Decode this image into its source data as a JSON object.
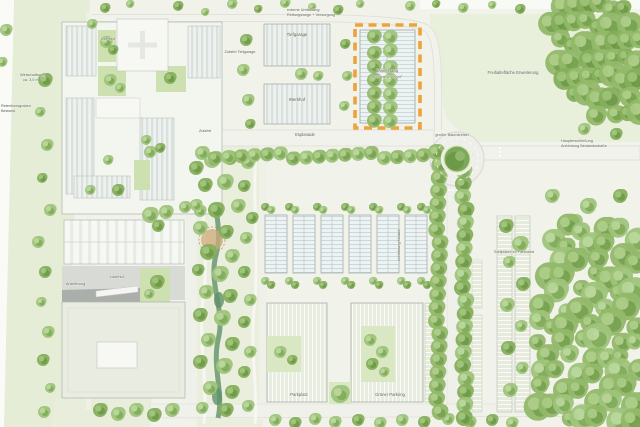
{
  "plan": {
    "labels": {
      "ring1": "externe Umfahrung",
      "ring2": "Rettungswege + Versorgung",
      "wirtschaftsweg1": "Wirtschaftsweg",
      "wirtschaftsweg2": "ca. 3,0 m",
      "retention1": "Retentionsgraben",
      "retention2": "Bestand",
      "innenhof": "Innenhof",
      "zufahrt_tiefgarage": "Zufahrt Tiefgarage",
      "tiefgarage": "Tiefgarage",
      "werkhof": "Werkhof",
      "erweiterung1": "Erweiterung",
      "erweiterung2": "BGF ca. 5.000 m²",
      "freihalteflaeche": "Freihaltefläche Erweiterung",
      "zufahrt": "Zufahrt",
      "esplanade": "Esplanade",
      "kreisel": "großer Baumkreisel",
      "anbindung1": "Haupterschließung",
      "anbindung2": "Anbindung Bestandsstraße",
      "parkband": "Stellplätze im Parkband",
      "module": "Umfahrung Module",
      "anlieferung": "Anlieferung",
      "ladehof": "Ladehof",
      "parkplatz": "Parkplatz",
      "parkring": "Grüner Parkring"
    },
    "highlight": {
      "name": "Erweiterungsfläche (orange markiert)",
      "color": "#EDA33B"
    }
  },
  "colors": {
    "accent_orange": "#EDA33B",
    "campus_ground": "#F1F3EA",
    "field_green": "#E5EDD7",
    "meadow_green": "#E8EFDB",
    "park_green": "#E9EFDC",
    "courtyard_green": "#CDE0B0",
    "hedge_green": "#D3E2BA",
    "road_gray": "#F2F2ED",
    "road_edge": "#DBDBD4",
    "building_white": "#F3F5EF",
    "roof_stripe": "#D9E1DE",
    "glass_roof": "#EDF2F2",
    "glass_line": "#CBD9DD",
    "gray_roof": "#ABAFAB",
    "apron_gray": "#D8DAD5",
    "water_green": "#5F9168",
    "sand_brown": "#CFA97A",
    "tree_base": "#9FC47C",
    "tree_dark": "#7FAB57",
    "tree_light": "#B7D597",
    "forest_base": "#93B96A",
    "forest_dark": "#74A04B",
    "forest_light": "#A9CB83"
  }
}
